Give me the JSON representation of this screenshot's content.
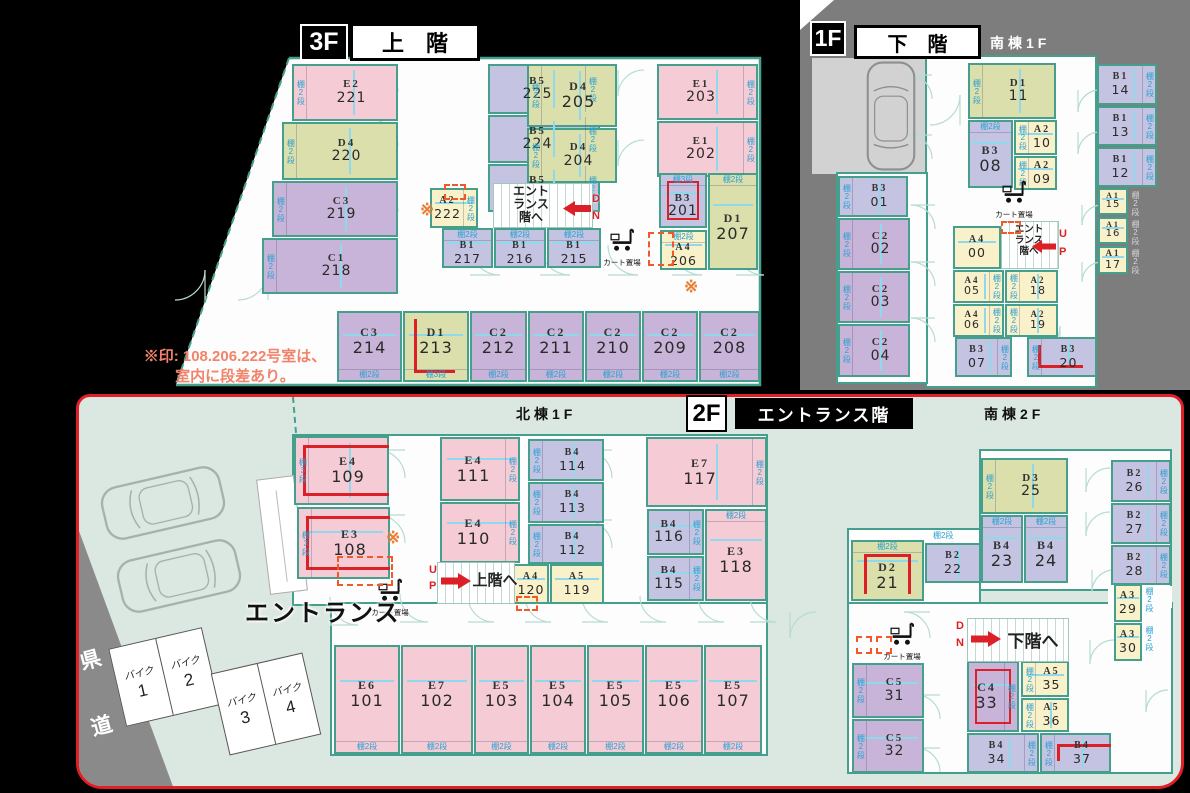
{
  "headers": {
    "f3": {
      "tag": "3F",
      "title": "上　階"
    },
    "f1": {
      "tag": "1F",
      "title": "下　階",
      "wing": "南棟1F"
    },
    "f2": {
      "tag": "2F",
      "title": "エントランス階",
      "wing_north": "北棟1F",
      "wing_south": "南棟2F"
    }
  },
  "note": {
    "line1": "※印: 108.206.222号室は、",
    "line2": "室内に段差あり。"
  },
  "labels": {
    "cart": "カート置場",
    "entrance": "エントランス",
    "road": "県道",
    "shelf2": "棚2段",
    "shelf3": "棚3段",
    "star": "※",
    "up_to": "上階へ",
    "down_to": "下階へ",
    "entrance_stairs": [
      "エント",
      "ランス",
      "階へ"
    ],
    "up_letters": [
      "U",
      "P"
    ],
    "down_letters": [
      "D",
      "N"
    ],
    "bike": "バイク"
  },
  "parking": {
    "bikes": [
      "1",
      "2",
      "3",
      "4"
    ]
  },
  "rooms": {
    "f3": [
      [
        "E2",
        "221",
        "p",
        2,
        "l",
        292,
        64,
        106,
        57
      ],
      [
        "D4",
        "220",
        "g",
        2,
        "l",
        282,
        122,
        116,
        58
      ],
      [
        "C3",
        "219",
        "u",
        2,
        "l",
        272,
        181,
        126,
        56
      ],
      [
        "C1",
        "218",
        "u",
        2,
        "l",
        262,
        238,
        136,
        56
      ],
      [
        "B5",
        "225",
        "l",
        2,
        "r",
        488,
        64,
        112,
        50
      ],
      [
        "B5",
        "224",
        "l",
        2,
        "r",
        488,
        115,
        112,
        48
      ],
      [
        "B5",
        "223",
        "l",
        2,
        "r",
        488,
        164,
        112,
        48
      ],
      [
        "A2",
        "222",
        "y",
        2,
        "r",
        430,
        188,
        48,
        40
      ],
      [
        "B1",
        "217",
        "l",
        2,
        "t",
        442,
        228,
        51,
        40
      ],
      [
        "B1",
        "216",
        "l",
        2,
        "t",
        494,
        228,
        52,
        40
      ],
      [
        "B1",
        "215",
        "l",
        2,
        "t",
        547,
        228,
        54,
        40
      ],
      [
        "D4",
        "205",
        "g",
        2,
        "l",
        527,
        64,
        90,
        63
      ],
      [
        "D4",
        "204",
        "g",
        2,
        "l",
        527,
        128,
        90,
        55
      ],
      [
        "E1",
        "203",
        "p",
        2,
        "r",
        657,
        64,
        101,
        56
      ],
      [
        "E1",
        "202",
        "p",
        2,
        "r",
        657,
        121,
        101,
        56
      ],
      [
        "B3",
        "201",
        "l",
        3,
        "t",
        659,
        173,
        48,
        55,
        "rect"
      ],
      [
        "D1",
        "207",
        "g",
        2,
        "t",
        708,
        173,
        50,
        97
      ],
      [
        "A4",
        "206",
        "y",
        2,
        "t",
        660,
        230,
        47,
        40
      ],
      [
        "C3",
        "214",
        "u",
        2,
        "b",
        337,
        311,
        65,
        71
      ],
      [
        "D1",
        "213",
        "g",
        3,
        "b",
        403,
        311,
        66,
        71,
        "L"
      ],
      [
        "C2",
        "212",
        "u",
        2,
        "b",
        470,
        311,
        57,
        71
      ],
      [
        "C2",
        "211",
        "u",
        2,
        "b",
        528,
        311,
        56,
        71
      ],
      [
        "C2",
        "210",
        "u",
        2,
        "b",
        585,
        311,
        56,
        71
      ],
      [
        "C2",
        "209",
        "u",
        2,
        "b",
        642,
        311,
        56,
        71
      ],
      [
        "C2",
        "208",
        "u",
        2,
        "b",
        699,
        311,
        61,
        71
      ]
    ],
    "f1": [
      [
        "D1",
        "11",
        "g",
        2,
        "l",
        968,
        63,
        88,
        56
      ],
      [
        "B3",
        "08",
        "l",
        2,
        "t",
        968,
        120,
        45,
        68
      ],
      [
        "A2",
        "10",
        "y",
        2,
        "l",
        1014,
        120,
        43,
        35
      ],
      [
        "A2",
        "09",
        "y",
        2,
        "l",
        1014,
        156,
        43,
        34
      ],
      [
        "B1",
        "14",
        "l",
        2,
        "r",
        1097,
        64,
        60,
        41
      ],
      [
        "B1",
        "13",
        "l",
        2,
        "r",
        1097,
        106,
        60,
        40
      ],
      [
        "B1",
        "12",
        "l",
        2,
        "r",
        1097,
        147,
        60,
        40
      ],
      [
        "A1",
        "15",
        "y",
        2,
        "rg",
        1098,
        188,
        30,
        27
      ],
      [
        "A1",
        "16",
        "y",
        2,
        "rg",
        1098,
        217,
        30,
        27
      ],
      [
        "A1",
        "17",
        "y",
        2,
        "rg",
        1098,
        246,
        30,
        28
      ],
      [
        "B3",
        "01",
        "l",
        2,
        "l",
        838,
        176,
        70,
        41
      ],
      [
        "C2",
        "02",
        "u",
        2,
        "l",
        838,
        218,
        72,
        52
      ],
      [
        "C2",
        "03",
        "u",
        2,
        "l",
        838,
        271,
        72,
        52
      ],
      [
        "C2",
        "04",
        "u",
        2,
        "l",
        838,
        324,
        72,
        53
      ],
      [
        "A4",
        "00",
        "y",
        0,
        "",
        953,
        226,
        48,
        43
      ],
      [
        "A4",
        "05",
        "y",
        2,
        "r",
        953,
        270,
        51,
        33
      ],
      [
        "A2",
        "18",
        "y",
        2,
        "l",
        1005,
        270,
        53,
        33
      ],
      [
        "A4",
        "06",
        "y",
        2,
        "r",
        953,
        304,
        51,
        33
      ],
      [
        "A2",
        "19",
        "y",
        2,
        "l",
        1005,
        304,
        53,
        33
      ],
      [
        "B3",
        "07",
        "l",
        2,
        "r",
        955,
        337,
        57,
        40
      ],
      [
        "B3",
        "20",
        "l",
        2,
        "l",
        1027,
        337,
        70,
        40,
        "L"
      ]
    ],
    "f2n": [
      [
        "E4",
        "109",
        "p",
        3,
        "l",
        294,
        436,
        95,
        69,
        "open"
      ],
      [
        "E3",
        "108",
        "p",
        3,
        "l",
        297,
        507,
        93,
        72,
        "open"
      ],
      [
        "E4",
        "111",
        "p",
        2,
        "r",
        440,
        437,
        80,
        64
      ],
      [
        "E4",
        "110",
        "p",
        2,
        "r",
        440,
        502,
        80,
        61
      ],
      [
        "B4",
        "114",
        "l",
        2,
        "l",
        528,
        439,
        76,
        42
      ],
      [
        "B4",
        "113",
        "l",
        2,
        "l",
        528,
        482,
        76,
        41
      ],
      [
        "B4",
        "112",
        "l",
        2,
        "l",
        528,
        524,
        76,
        40
      ],
      [
        "A4",
        "120",
        "y",
        0,
        "",
        513,
        564,
        36,
        40
      ],
      [
        "A5",
        "119",
        "y",
        0,
        "",
        550,
        564,
        54,
        40
      ],
      [
        "E7",
        "117",
        "p",
        2,
        "r",
        646,
        437,
        121,
        70
      ],
      [
        "B4",
        "116",
        "l",
        2,
        "r",
        647,
        509,
        57,
        46
      ],
      [
        "B4",
        "115",
        "l",
        2,
        "r",
        647,
        556,
        57,
        45
      ],
      [
        "E3",
        "118",
        "p",
        2,
        "t",
        705,
        509,
        62,
        92
      ],
      [
        "E6",
        "101",
        "p",
        2,
        "b",
        334,
        645,
        66,
        109
      ],
      [
        "E7",
        "102",
        "p",
        2,
        "b",
        401,
        645,
        72,
        109
      ],
      [
        "E5",
        "103",
        "p",
        2,
        "b",
        474,
        645,
        55,
        109
      ],
      [
        "E5",
        "104",
        "p",
        2,
        "b",
        530,
        645,
        56,
        109
      ],
      [
        "E5",
        "105",
        "p",
        2,
        "b",
        587,
        645,
        57,
        109
      ],
      [
        "E5",
        "106",
        "p",
        2,
        "b",
        645,
        645,
        58,
        109
      ],
      [
        "E5",
        "107",
        "p",
        2,
        "b",
        704,
        645,
        58,
        109
      ]
    ],
    "f2s": [
      [
        "D3",
        "25",
        "g",
        2,
        "l",
        981,
        458,
        87,
        56
      ],
      [
        "B2",
        "26",
        "l",
        2,
        "r",
        1111,
        460,
        60,
        42
      ],
      [
        "B2",
        "27",
        "l",
        2,
        "r",
        1111,
        503,
        60,
        41
      ],
      [
        "B2",
        "28",
        "l",
        2,
        "r",
        1111,
        545,
        60,
        40
      ],
      [
        "B4",
        "23",
        "l",
        2,
        "t",
        981,
        515,
        42,
        68
      ],
      [
        "B4",
        "24",
        "l",
        2,
        "t",
        1024,
        515,
        44,
        68
      ],
      [
        "B2",
        "22",
        "l",
        2,
        "to",
        925,
        543,
        56,
        40
      ],
      [
        "D2",
        "21",
        "g",
        2,
        "t",
        851,
        540,
        73,
        61,
        "openb"
      ],
      [
        "A3",
        "29",
        "y",
        2,
        "ro",
        1114,
        584,
        28,
        38
      ],
      [
        "A3",
        "30",
        "y",
        2,
        "ro",
        1114,
        623,
        28,
        38
      ],
      [
        "C5",
        "31",
        "u",
        2,
        "l",
        852,
        663,
        72,
        55
      ],
      [
        "C5",
        "32",
        "u",
        2,
        "l",
        852,
        719,
        72,
        54
      ],
      [
        "C4",
        "33",
        "u",
        2,
        "r",
        967,
        661,
        52,
        71,
        "rect"
      ],
      [
        "A5",
        "35",
        "y",
        2,
        "l",
        1021,
        661,
        48,
        36
      ],
      [
        "A5",
        "36",
        "y",
        2,
        "l",
        1021,
        698,
        48,
        34
      ],
      [
        "B4",
        "34",
        "l",
        2,
        "r",
        967,
        733,
        72,
        40
      ],
      [
        "B4",
        "37",
        "l",
        2,
        "l",
        1040,
        733,
        71,
        40,
        "tl"
      ]
    ]
  }
}
